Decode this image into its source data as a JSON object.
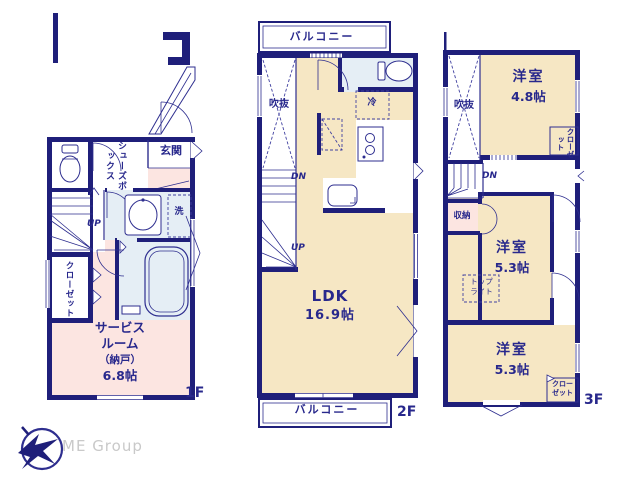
{
  "colors": {
    "wall_navy": "#1f1f7a",
    "line_navy": "#2e2e8f",
    "text_navy": "#28288c",
    "room_cream": "#f6e7c4",
    "room_pink": "#fce5e1",
    "room_blue": "#e5eef5",
    "logo_gray": "#c9c9c9"
  },
  "floor1": {
    "label": "1F",
    "entrance": "玄関",
    "shoe_box": "シューズボックス",
    "laundry": "洗",
    "stairs_up": "UP",
    "closet": "クローゼット",
    "service_room": {
      "line1": "サービス",
      "line2": "ルーム",
      "line3": "（納戸）",
      "line4": "6.8帖"
    }
  },
  "floor2": {
    "label": "2F",
    "balcony_top": "バルコニー",
    "void": "吹抜",
    "fridge": "冷",
    "stairs_dn": "DN",
    "stairs_up": "UP",
    "ldk": {
      "name": "LDK",
      "size": "16.9帖"
    },
    "balcony_bottom": "バルコニー"
  },
  "floor3": {
    "label": "3F",
    "void": "吹抜",
    "stairs_dn": "DN",
    "storage": "収納",
    "closet_top": "クローゼット",
    "room_48": {
      "name": "洋室",
      "size": "4.8帖"
    },
    "room_53_mid": {
      "name": "洋室",
      "size": "5.3帖"
    },
    "toplight": {
      "line1": "トップ",
      "line2": "ライト"
    },
    "room_53_btm": {
      "name": "洋室",
      "size": "5.3帖"
    },
    "closet_btm": {
      "line1": "クロー",
      "line2": "ゼット"
    }
  },
  "logo": {
    "text": "ME Group"
  }
}
